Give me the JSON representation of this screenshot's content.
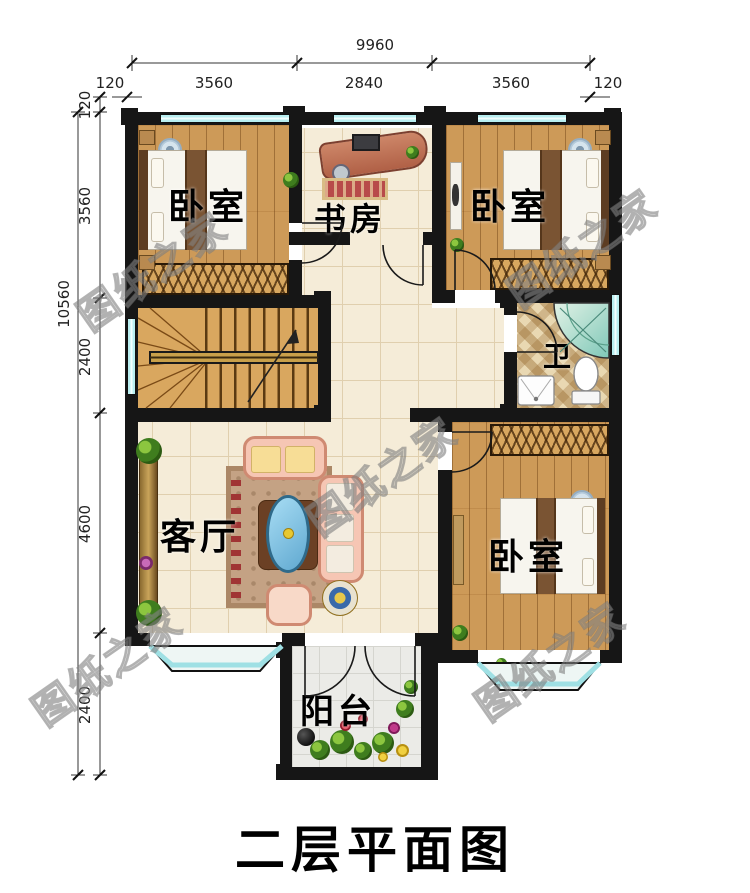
{
  "title": "二层平面图",
  "watermark_text": "图纸之家",
  "rooms": {
    "bedroom_top_left": "卧室",
    "study": "书房",
    "bedroom_top_right": "卧室",
    "bathroom": "卫",
    "living_room": "客厅",
    "bedroom_bottom_right": "卧室",
    "balcony": "阳台"
  },
  "dimensions": {
    "top": {
      "total": "9960",
      "edge_left": "120",
      "seg1": "3560",
      "seg2": "2840",
      "seg3": "3560",
      "edge_right": "120"
    },
    "left": {
      "total": "10560",
      "edge_top": "120",
      "seg1": "3560",
      "seg2": "2400",
      "seg3": "4600",
      "seg4": "2400"
    }
  },
  "colors": {
    "wall": "#161616",
    "window_glass": "#b9eff1",
    "wood_floor": "#cd9a58",
    "tile_floor": "#f5ecd8",
    "sofa_accent": "#f6c6b4",
    "title_color": "#000000"
  }
}
